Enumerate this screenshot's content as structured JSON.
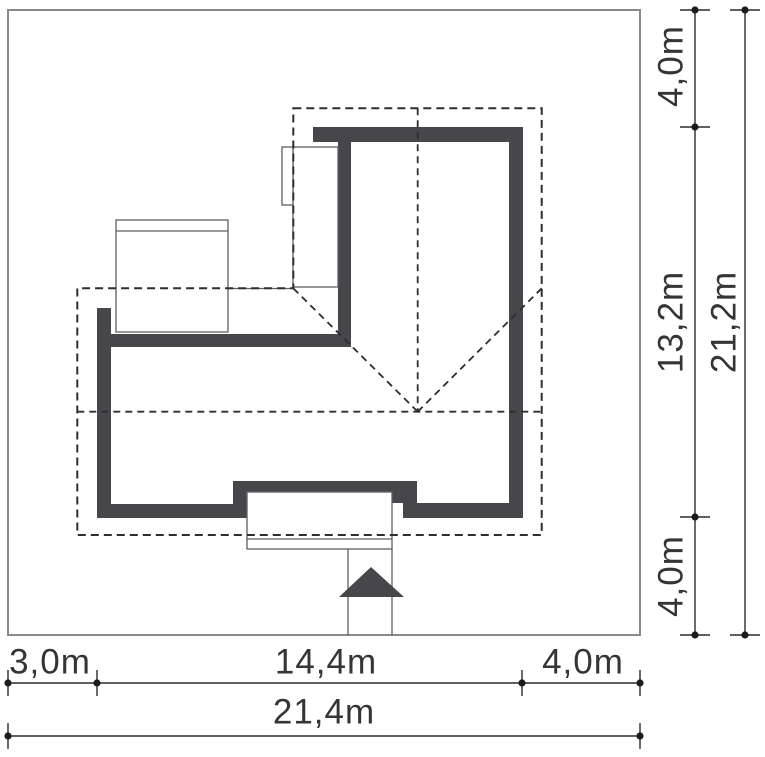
{
  "colors": {
    "wall": "#46464b",
    "dash": "#2e2e32",
    "thin": "#5f5f64",
    "dim": "#2b2b2e",
    "plot_border": "#8a8a8a",
    "text": "#353538",
    "white": "#ffffff"
  },
  "plot": {
    "x": 8,
    "y": 10,
    "w": 632,
    "h": 625
  },
  "walls": [
    {
      "x": 313,
      "y": 127,
      "w": 210,
      "h": 15
    },
    {
      "x": 338,
      "y": 127,
      "w": 13,
      "h": 220
    },
    {
      "x": 509,
      "y": 127,
      "w": 14,
      "h": 391
    },
    {
      "x": 97,
      "y": 334,
      "w": 254,
      "h": 13
    },
    {
      "x": 97,
      "y": 308,
      "w": 14,
      "h": 210
    },
    {
      "x": 97,
      "y": 504,
      "w": 150,
      "h": 14
    },
    {
      "x": 233,
      "y": 481,
      "w": 14,
      "h": 37
    },
    {
      "x": 233,
      "y": 481,
      "w": 174,
      "h": 13
    },
    {
      "x": 390,
      "y": 481,
      "w": 27,
      "h": 22
    },
    {
      "x": 403,
      "y": 503,
      "w": 120,
      "h": 15
    }
  ],
  "structures": [
    {
      "name": "garage",
      "x": 116,
      "y": 220,
      "w": 112,
      "h": 112,
      "lines": [
        {
          "x1": 116,
          "y1": 231,
          "x2": 228,
          "y2": 231
        }
      ]
    },
    {
      "name": "annex",
      "x": 293,
      "y": 147,
      "w": 45,
      "h": 140,
      "lines": []
    },
    {
      "name": "chimney",
      "x": 282,
      "y": 147,
      "w": 11,
      "h": 58,
      "lines": []
    },
    {
      "name": "porch",
      "x": 247,
      "y": 492,
      "w": 145,
      "h": 57,
      "lines": [
        {
          "x1": 247,
          "y1": 539,
          "x2": 392,
          "y2": 539
        }
      ]
    }
  ],
  "extra_lines": [
    {
      "name": "terrace-edge-line",
      "x1": 228,
      "y1": 288.5,
      "x2": 293,
      "y2": 288.5
    },
    {
      "name": "driveway-line-left",
      "x1": 348,
      "y1": 549,
      "x2": 348,
      "y2": 635
    },
    {
      "name": "driveway-line-right",
      "x1": 392,
      "y1": 549,
      "x2": 392,
      "y2": 635
    }
  ],
  "roof": {
    "eave": [
      [
        293.3,
        108.3
      ],
      [
        541.7,
        108.3
      ],
      [
        541.7,
        535
      ],
      [
        77.3,
        535
      ],
      [
        77.3,
        288.3
      ],
      [
        293.3,
        288.3
      ]
    ],
    "lines": [
      [
        [
          417.7,
          108.3
        ],
        [
          417.7,
          411.7
        ]
      ],
      [
        [
          77.3,
          411.7
        ],
        [
          541.7,
          411.7
        ]
      ],
      [
        [
          293.3,
          288.3
        ],
        [
          417.7,
          411.7
        ]
      ],
      [
        [
          417.7,
          411.7
        ],
        [
          541.7,
          288.3
        ]
      ]
    ]
  },
  "entrance_arrow": [
    [
      339,
      597
    ],
    [
      404,
      597
    ],
    [
      371,
      567
    ]
  ],
  "dim_lines": [
    {
      "o": "h",
      "pos": 683,
      "from": 8,
      "to": 640,
      "dots": [
        8,
        97,
        522,
        640
      ]
    },
    {
      "o": "h",
      "pos": 736,
      "from": 8,
      "to": 640,
      "dots": [
        8,
        640
      ]
    },
    {
      "o": "v",
      "pos": 695,
      "from": 10,
      "to": 635,
      "dots": [
        10,
        127,
        517,
        635
      ]
    },
    {
      "o": "v",
      "pos": 745,
      "from": 10,
      "to": 635,
      "dots": [
        10,
        635
      ]
    }
  ],
  "dimensions": {
    "bottom": [
      {
        "label": "3,0m",
        "cx": 50,
        "cy": 662
      },
      {
        "label": "14,4m",
        "cx": 326,
        "cy": 662
      },
      {
        "label": "4,0m",
        "cx": 583,
        "cy": 662
      },
      {
        "label": "21,4m",
        "cx": 324,
        "cy": 712
      }
    ],
    "right": [
      {
        "label": "4,0m",
        "cx": 671,
        "cy": 66
      },
      {
        "label": "13,2m",
        "cx": 671,
        "cy": 322
      },
      {
        "label": "4,0m",
        "cx": 671,
        "cy": 576
      },
      {
        "label": "21,2m",
        "cx": 724,
        "cy": 322
      }
    ]
  }
}
